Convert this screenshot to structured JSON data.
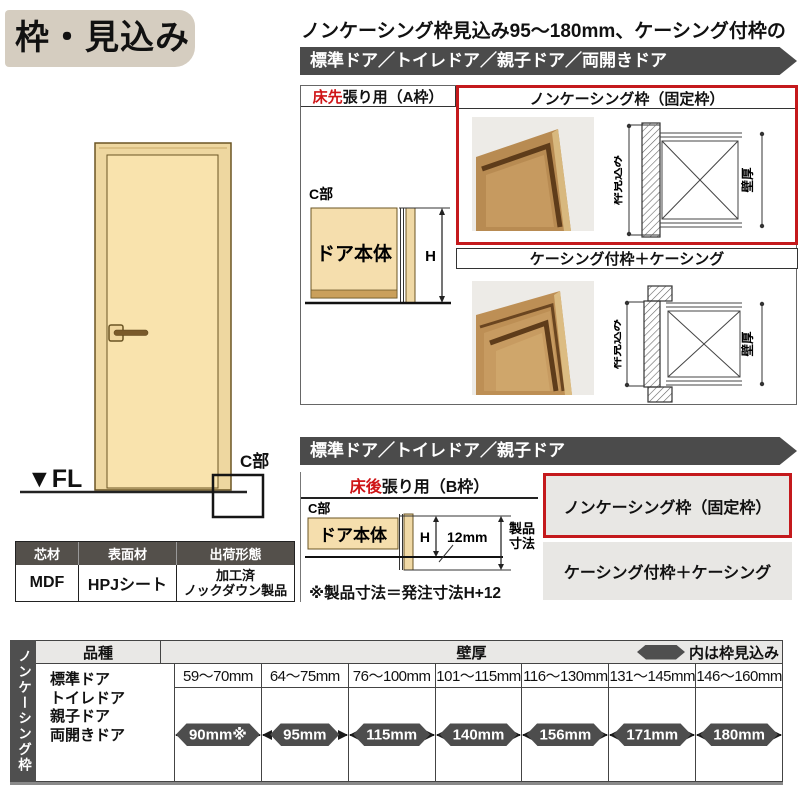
{
  "title": "枠・見込み",
  "subtitle": "ノンケーシング枠見込み95～180mm、ケーシング付枠の場合",
  "banner_a": "標準ドア／トイレドア／親子ドア／両開きドア",
  "banner_b": "標準ドア／トイレドア／親子ドア",
  "section_a": {
    "header_red": "床先",
    "header_black": "張り用（A枠）",
    "box_noncasing": "ノンケーシング枠（固定枠）",
    "box_casing": "ケーシング付枠＋ケーシング",
    "c_label": "C部",
    "door_body": "ドア本体",
    "h_label": "H",
    "depth_label": "枠見込み",
    "wall_label": "壁厚"
  },
  "section_b": {
    "header_red": "床後",
    "header_black": "張り用（B枠）",
    "box_noncasing": "ノンケーシング枠（固定枠）",
    "box_casing": "ケーシング付枠＋ケーシング",
    "c_label": "C部",
    "door_body": "ドア本体",
    "h_label": "H",
    "gap_label": "12mm",
    "product_label_line1": "製品",
    "product_label_line2": "寸法",
    "note": "※製品寸法＝発注寸法H+12"
  },
  "door_figure": {
    "fl_label": "▼FL",
    "c_label": "C部"
  },
  "materials_table": {
    "headers": [
      "芯材",
      "表面材",
      "出荷形態"
    ],
    "core": "MDF",
    "surface": "HPJシート",
    "shipping_line1": "加工済",
    "shipping_line2": "ノックダウン製品"
  },
  "spec_table": {
    "side_label": "ノンケーシング枠",
    "kind_header": "品種",
    "wall_header": "壁厚",
    "legend": "内は枠見込み",
    "door_types": [
      "標準ドア",
      "トイレドア",
      "親子ドア",
      "両開きドア"
    ],
    "columns": [
      {
        "range": "59～70mm",
        "value": "90mm※"
      },
      {
        "range": "64～75mm",
        "value": "95mm"
      },
      {
        "range": "76～100mm",
        "value": "115mm"
      },
      {
        "range": "101～115mm",
        "value": "140mm"
      },
      {
        "range": "116～130mm",
        "value": "156mm"
      },
      {
        "range": "131～145mm",
        "value": "171mm"
      },
      {
        "range": "146～160mm",
        "value": "180mm"
      }
    ]
  },
  "colors": {
    "accent_red": "#c4191c",
    "dark_gray": "#4b4b4b",
    "tan": "#f5dead",
    "title_bg": "#d5cdc0"
  }
}
